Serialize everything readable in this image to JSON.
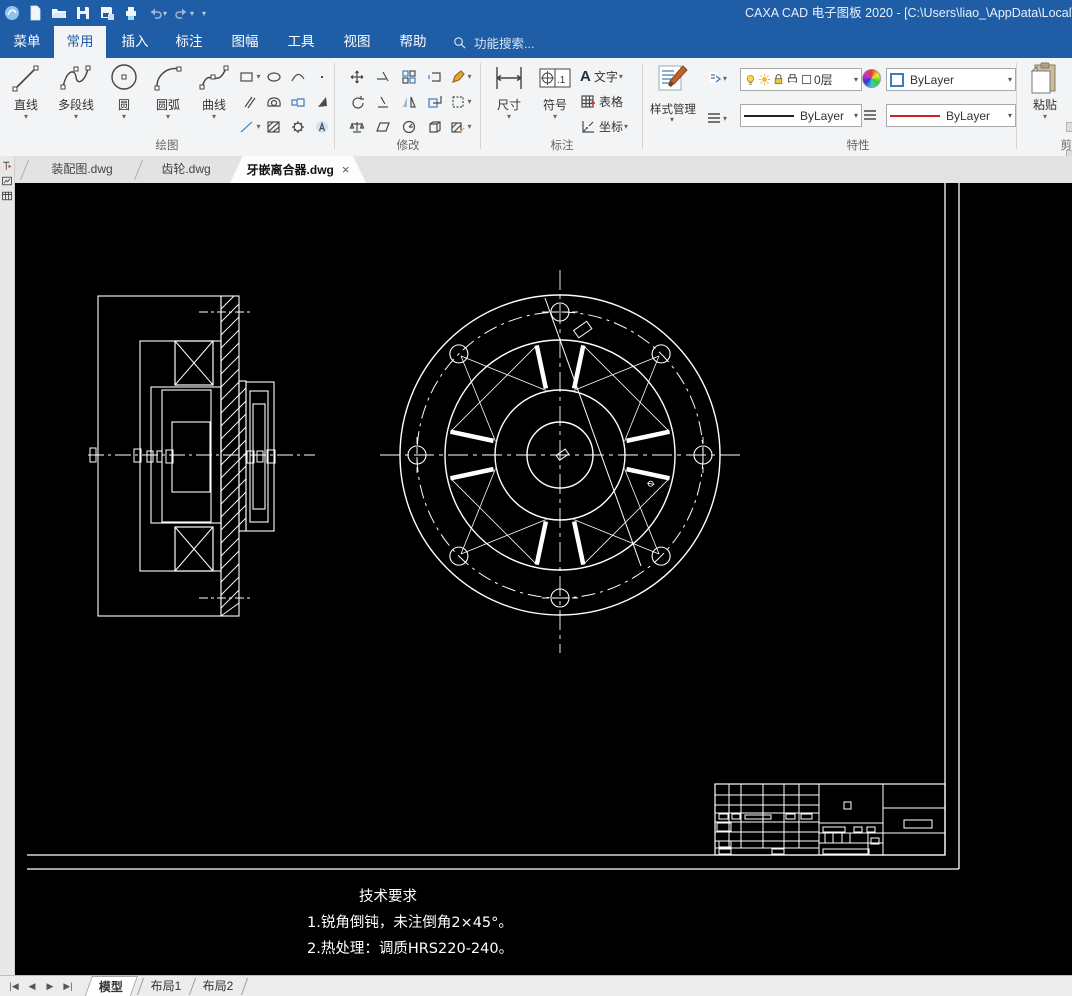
{
  "window": {
    "title": "CAXA CAD 电子图板 2020 - [C:\\Users\\liao_\\AppData\\Local\\Te"
  },
  "menu": {
    "tabs": [
      "菜单",
      "常用",
      "插入",
      "标注",
      "图幅",
      "工具",
      "视图",
      "帮助"
    ],
    "active_tab": "常用",
    "search": "功能搜索..."
  },
  "ribbon": {
    "draw_group": {
      "label": "绘图",
      "buttons": [
        "直线",
        "多段线",
        "圆",
        "圆弧",
        "曲线"
      ]
    },
    "modify_group": {
      "label": "修改"
    },
    "dim_group": {
      "label": "标注",
      "dim": "尺寸",
      "symbol": "符号",
      "symbol_icon_text": ".1",
      "text_icon_letter": "A",
      "text": "文字",
      "table": "表格",
      "coord": "坐标"
    },
    "style_group": {
      "label": "样式管理"
    },
    "props_group": {
      "label": "特性",
      "layer": "0层",
      "color": "ByLayer",
      "linetype": "ByLayer",
      "lineweight": "ByLayer"
    },
    "clipboard_group": {
      "paste": "粘贴",
      "partial_label": "剪"
    }
  },
  "doc_tabs": [
    "装配图.dwg",
    "齿轮.dwg",
    "牙嵌离合器.dwg"
  ],
  "active_doc_tab": "牙嵌离合器.dwg",
  "drawing": {
    "tech_req_title": "技术要求",
    "tech_req_1": "1.锐角倒钝，未注倒角2×45°。",
    "tech_req_2": "2.热处理：调质HRS220-240。",
    "dim_symbol": "⌀"
  },
  "bottom_tabs": [
    "模型",
    "布局1",
    "布局2"
  ],
  "active_bottom_tab": "模型",
  "colors": {
    "accent_blue": "#1f5da6",
    "canvas": "#000000",
    "cad_line": "#ffffff"
  }
}
